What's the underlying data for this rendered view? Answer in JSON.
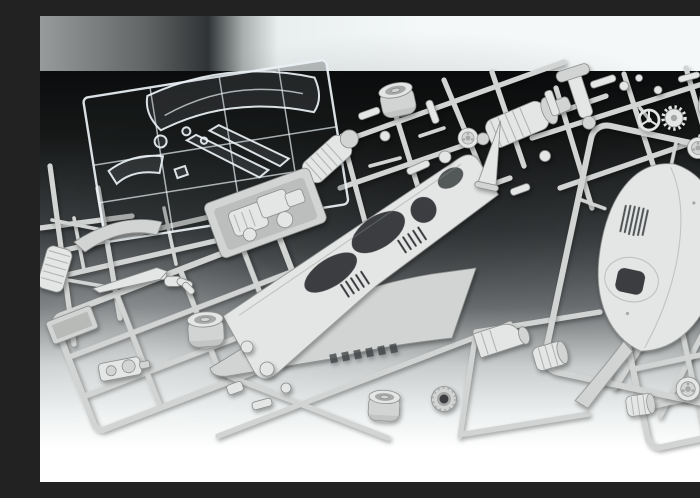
{
  "scene": {
    "description": "Studio product photograph of an unassembled plastic scale model kit: overlapping light-grey injection-moulded sprues holding a streamlined teardrop body shell with louvres and cockpit opening, large body side panels with oval cut-outs, barrel tyres, wheel discs, engine, gearbox and chassis fittings, plus one clear sprue with windscreen parts at the top left, laid on a backdrop fading from black at the top to white at the bottom.",
    "subject": "plastic model kit sprues",
    "photo_style": "studio product photo, gradient sweep backdrop",
    "text_visible": false
  },
  "objects": {
    "clear_sprue": {
      "label": "clear parts sprue",
      "parts": [
        "large windscreen",
        "small windscreen",
        "window strips",
        "small lenses"
      ]
    },
    "teardrop_body": {
      "label": "streamlined upper body shell",
      "features": [
        "side louvres",
        "cockpit opening",
        "tapered tail"
      ]
    },
    "body_panels": {
      "label": "body side panels",
      "features": [
        "oval cut-outs",
        "round wheel opening",
        "louvre slits",
        "vent slots"
      ]
    },
    "wheels": {
      "label": "tyres, wheel discs and brake drums",
      "tyres_visible": 4,
      "discs_visible": 3
    },
    "drivetrain": {
      "label": "engine block, supercharger, gearbox bell, ribbed drums"
    },
    "figure": {
      "label": "driver figure"
    },
    "controls": {
      "label": "steering wheel and gear wheel"
    }
  },
  "colors": {
    "plastic": "#d2d4d3",
    "plastic_light": "#e4e6e5",
    "plastic_shadow": "#a6a8a7",
    "plastic_edge": "#8b8d8c",
    "dark_detail": "#3a3e40",
    "clear_edge": "rgba(235,242,245,0.92)",
    "clear_fill": "rgba(145,155,160,0.15)",
    "bg_top": "#0a0b0c",
    "bg_upper": "#161818",
    "bg_upper2": "#3c4042",
    "bg_mid": "#6e7274",
    "bg_lower": "#c8cccc",
    "bg_lower2": "#eef1f1",
    "bg_white": "#ffffff",
    "band_left": "#979b9b",
    "band_mid": "#616565",
    "band_dark": "#2f3335",
    "band_fade": "#a9aeae",
    "band_light": "#e9eeee",
    "band_right": "#f4f8f8"
  }
}
